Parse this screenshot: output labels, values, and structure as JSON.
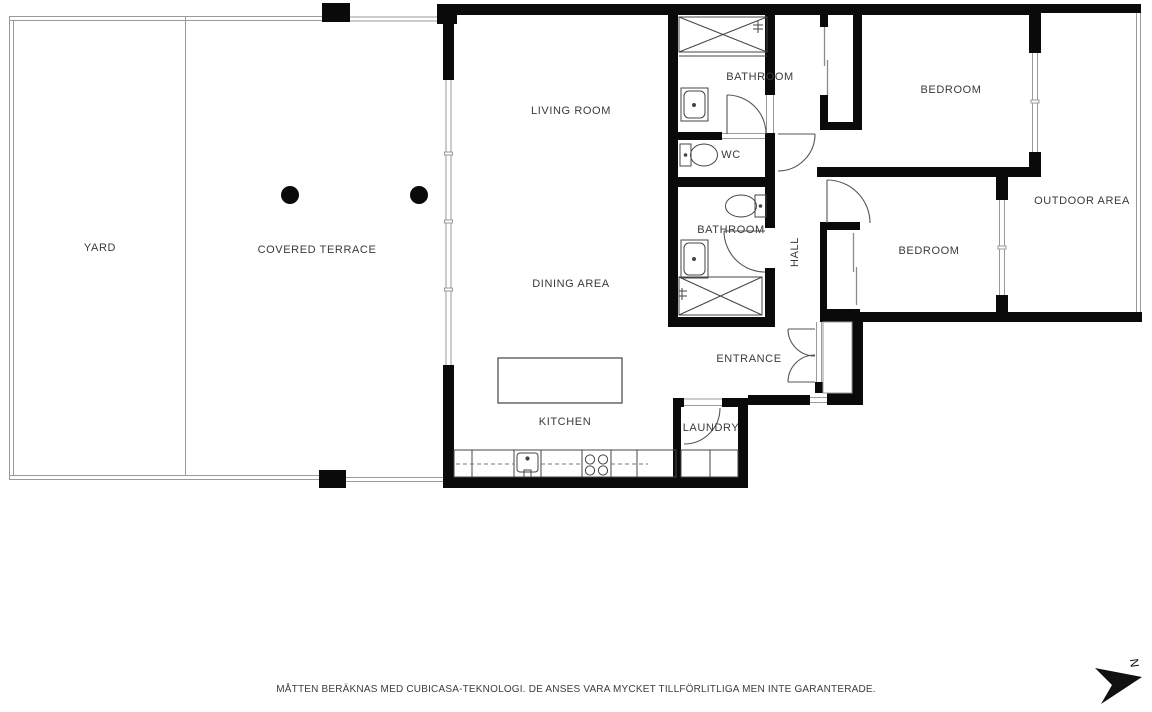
{
  "plan": {
    "rooms": {
      "yard": "YARD",
      "covered_terrace": "COVERED TERRACE",
      "living_room": "LIVING ROOM",
      "dining_area": "DINING AREA",
      "kitchen": "KITCHEN",
      "laundry": "LAUNDRY",
      "entrance": "ENTRANCE",
      "hall": "HALL",
      "wc": "WC",
      "bathroom_upper": "BATHROOM",
      "bathroom_lower": "BATHROOM",
      "bedroom_upper": "BEDROOM",
      "bedroom_lower": "BEDROOM",
      "outdoor_area": "OUTDOOR AREA"
    },
    "compass": {
      "north_label": "N"
    },
    "footer": {
      "disclaimer": "MÅTTEN BERÄKNAS MED CUBICASA-TEKNOLOGI. DE ANSES VARA MYCKET TILLFÖRLITLIGA MEN INTE GARANTERADE."
    },
    "colors": {
      "wall": "#0a0a0a",
      "label_text": "#3a3a3a",
      "thin_line": "#9a9a9a",
      "fixture_line": "#444444"
    }
  }
}
